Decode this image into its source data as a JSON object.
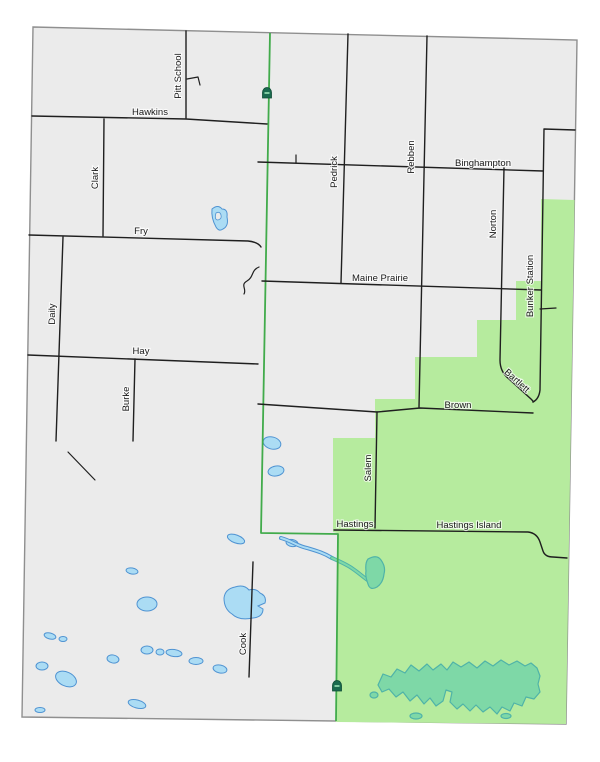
{
  "map": {
    "kind": "county-road-map",
    "colors": {
      "background": "#ffffff",
      "land": "#ebebeb",
      "county_outline": "#8f8f8f",
      "district_fill": "#b6eb9e",
      "boundary_line": "#41ab4b",
      "road": "#1f1f1f",
      "pond_fill": "#abdcf4",
      "pond_stroke": "#4f93d2",
      "wetland_fill": "#7ed8a7",
      "wetland_stroke": "#4fb3a8",
      "marker": "#1a6a4f"
    },
    "markers": {
      "icon": "landmark-dome-icon",
      "count": 2
    }
  },
  "road_labels": {
    "pitt_school": "Pitt School",
    "hawkins": "Hawkins",
    "clark": "Clark",
    "fry": "Fry",
    "daily": "Daily",
    "hay": "Hay",
    "burke": "Burke",
    "pedrick": "Pedrick",
    "rebben": "Rebben",
    "binghampton": "Binghampton",
    "norton": "Norton",
    "maine_prairie": "Maine Prairie",
    "bunker_station": "Bunker Station",
    "bartlett": "Bartlett",
    "brown": "Brown",
    "salem": "Salem",
    "hastings": "Hastings",
    "hastings_island": "Hastings Island",
    "cook": "Cook"
  }
}
